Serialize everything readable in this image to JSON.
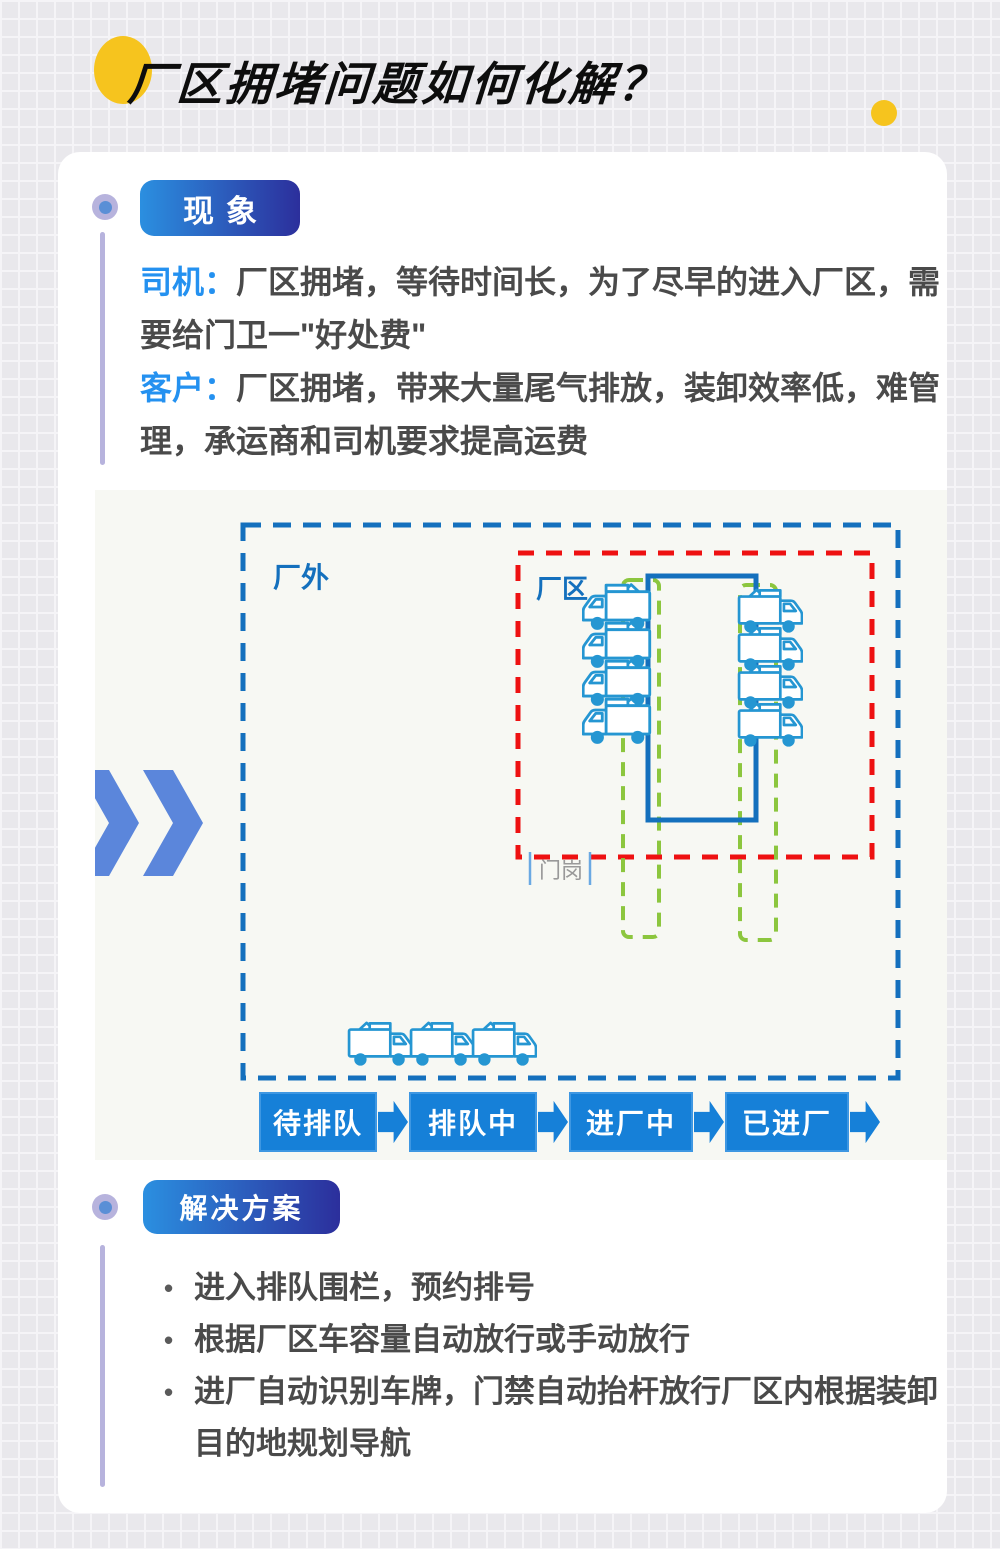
{
  "page": {
    "title": "厂区拥堵问题如何化解？"
  },
  "phenomenon": {
    "badge": "现象",
    "items": [
      {
        "label": "司机：",
        "text": "厂区拥堵，等待时间长，为了尽早的进入厂区，需要给门卫一\"好处费\""
      },
      {
        "label": "客户：",
        "text": "厂区拥堵，带来大量尾气排放，装卸效率低，难管理，承运商和司机要求提高运费"
      }
    ]
  },
  "diagram": {
    "outside_label": "厂外",
    "factory_label": "厂区",
    "gate_label": "门岗",
    "flow": [
      "待排队",
      "排队中",
      "进厂中",
      "已进厂"
    ]
  },
  "solution": {
    "badge": "解决方案",
    "bullets": [
      "进入排队围栏，预约排号",
      "根据厂区车容量自动放行或手动放行",
      "进厂自动识别车牌，门禁自动抬杆放行厂区内根据装卸目的地规划导航"
    ]
  },
  "colors": {
    "accent-blue": "#2491f0",
    "badge-gradient-start": "#2b8fe0",
    "badge-gradient-end": "#2c2f9c",
    "flow-blue": "#1680d8",
    "outline-blue": "#1470bd",
    "truck-blue": "#2596d2",
    "alert-red": "#ee1111",
    "lane-green": "#8cc63e",
    "chevron-blue": "#5b86db",
    "decor-yellow": "#f6c41e",
    "lavender": "#b7b3dd",
    "text-dark": "#4a4a4a",
    "gate-gray": "#999999",
    "bg-gray": "#e9e8ec",
    "grid-line": "#f5f4f7"
  }
}
